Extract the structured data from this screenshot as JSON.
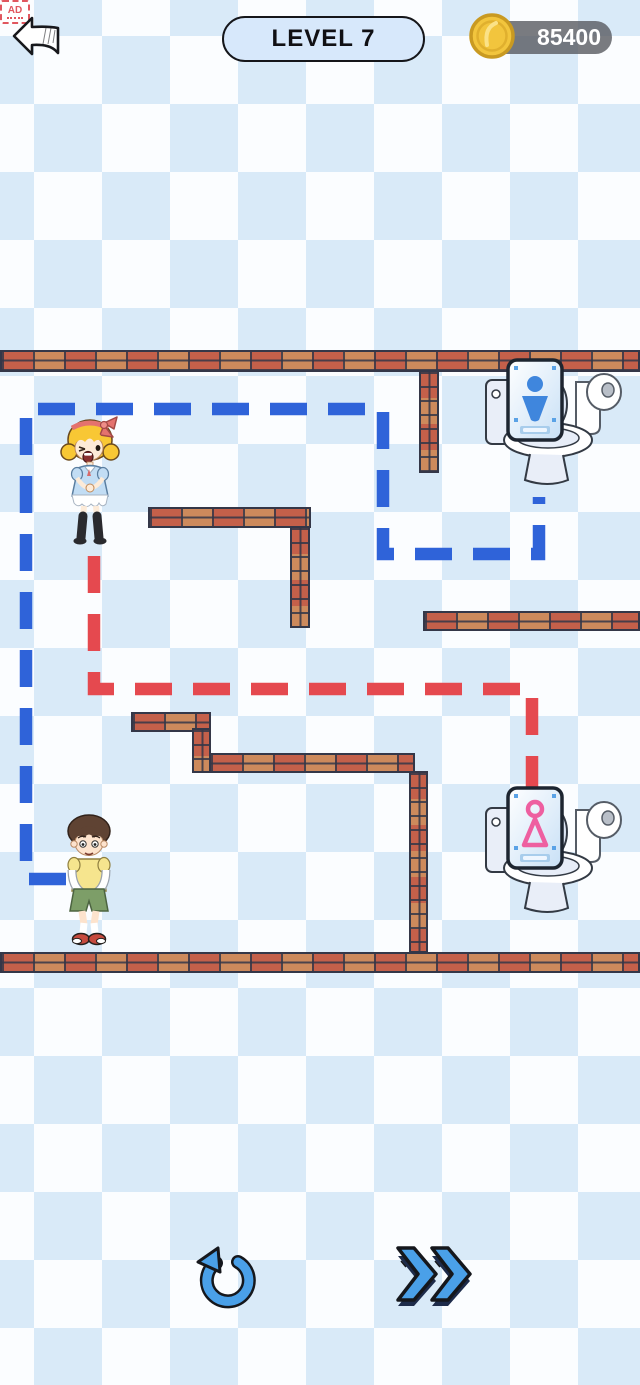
{
  "header": {
    "level_label": "LEVEL 7",
    "coin_count": "85400"
  },
  "footer": {
    "ad_label": "AD"
  },
  "colors": {
    "path_blue": "#2f63d9",
    "path_red": "#e5494f",
    "accent_blue": "#4aa0e8",
    "bg_diamond_blue": "#d9eaf8",
    "brick_red": "#c4604a",
    "brick_tan": "#cd8a5c",
    "sign_male_blue": "#3f86dd",
    "sign_female_pink": "#ee5fa0",
    "level_pill_bg": "#d7e8fb",
    "coin_gold": "#f2c53d"
  },
  "maze": {
    "walls": [
      {
        "x": 0,
        "y": 350,
        "w": 640,
        "h": 22,
        "o": "h"
      },
      {
        "x": 419,
        "y": 370,
        "w": 20,
        "h": 103,
        "o": "v"
      },
      {
        "x": 148,
        "y": 507,
        "w": 163,
        "h": 21,
        "o": "h"
      },
      {
        "x": 290,
        "y": 526,
        "w": 20,
        "h": 102,
        "o": "v"
      },
      {
        "x": 423,
        "y": 611,
        "w": 217,
        "h": 20,
        "o": "h"
      },
      {
        "x": 131,
        "y": 712,
        "w": 80,
        "h": 20,
        "o": "h"
      },
      {
        "x": 192,
        "y": 728,
        "w": 19,
        "h": 45,
        "o": "v"
      },
      {
        "x": 209,
        "y": 753,
        "w": 206,
        "h": 20,
        "o": "h"
      },
      {
        "x": 409,
        "y": 771,
        "w": 19,
        "h": 182,
        "o": "v"
      },
      {
        "x": 0,
        "y": 952,
        "w": 640,
        "h": 21,
        "o": "h"
      }
    ],
    "paths": [
      {
        "color": "blue",
        "points": [
          [
            66,
            879
          ],
          [
            26,
            879
          ],
          [
            26,
            409
          ],
          [
            383,
            409
          ],
          [
            383,
            554
          ],
          [
            539,
            554
          ],
          [
            539,
            497
          ]
        ]
      },
      {
        "color": "red",
        "points": [
          [
            94,
            556
          ],
          [
            94,
            689
          ],
          [
            532,
            689
          ],
          [
            532,
            800
          ]
        ]
      }
    ]
  },
  "entities": {
    "girl": {
      "x": 58,
      "y": 414
    },
    "boy": {
      "x": 54,
      "y": 812
    },
    "toilet_male": {
      "x": 478,
      "y": 346
    },
    "toilet_female": {
      "x": 478,
      "y": 774
    }
  }
}
